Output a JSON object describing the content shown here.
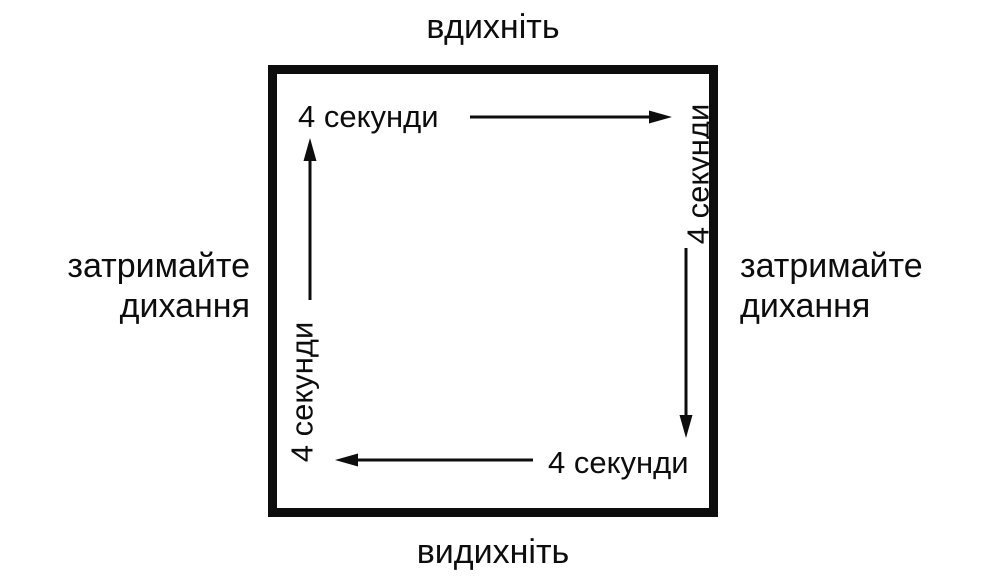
{
  "diagram": {
    "title_semantic": "box-breathing-cycle",
    "top": {
      "action": "вдихніть",
      "duration": "4 секунди",
      "direction": "right"
    },
    "right": {
      "action_line1": "затримайте",
      "action_line2": "дихання",
      "duration": "4 секунди",
      "direction": "down"
    },
    "bottom": {
      "action": "видихніть",
      "duration": "4 секунди",
      "direction": "left"
    },
    "left": {
      "action_line1": "затримайте",
      "action_line2": "дихання",
      "duration": "4 секунди",
      "direction": "up"
    },
    "colors": {
      "ink": "#0d0d0d",
      "background": "#ffffff"
    }
  }
}
